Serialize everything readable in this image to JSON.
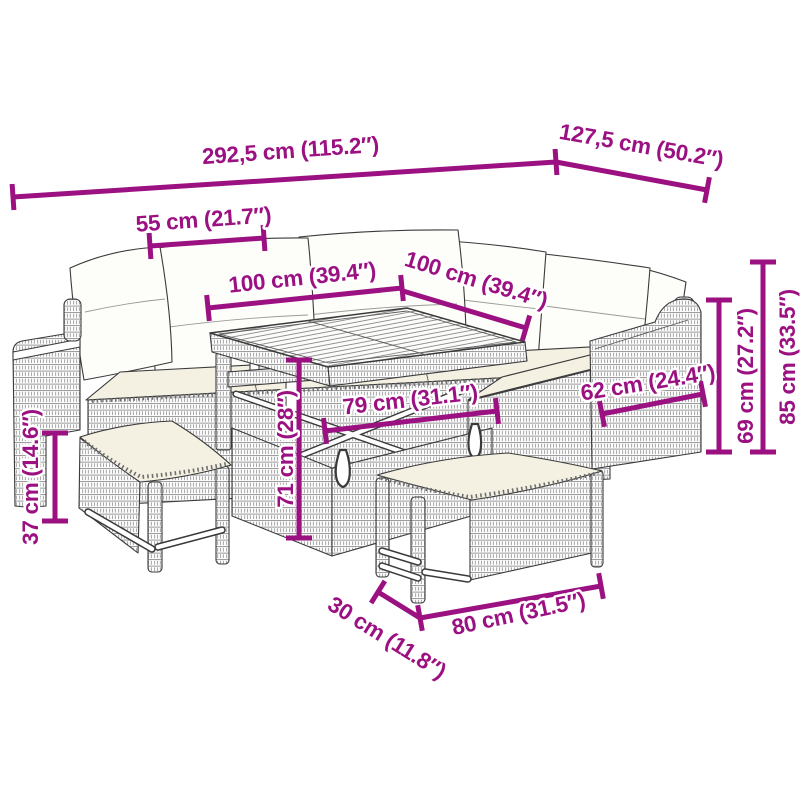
{
  "diagram": {
    "title": "garden-furniture-set-dimension-diagram",
    "accent_color": "#9C1181",
    "outline_color": "#3A3A3A",
    "dimensions": {
      "overall_width": "292,5 cm (115.2″)",
      "overall_depth": "127,5 cm (50.2″)",
      "seat_width": "55 cm (21.7″)",
      "table_length": "100 cm (39.4″)",
      "table_width": "100 cm (39.4″)",
      "arm_section_depth": "62 cm (24.4″)",
      "back_height": "69 cm (27.2″)",
      "overall_height": "85 cm (33.5″)",
      "table_height": "71 cm (28″)",
      "table_base_width": "79 cm (31.1″)",
      "bench_height": "37 cm (14.6″)",
      "bench_depth": "30 cm (11.8″)",
      "bench_length": "80 cm (31.5″)"
    }
  }
}
